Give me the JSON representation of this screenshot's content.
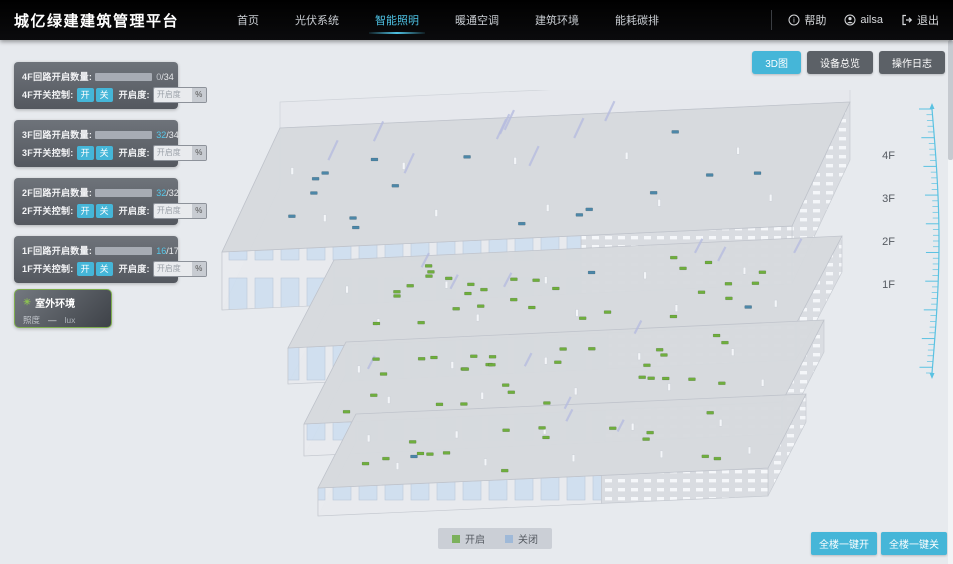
{
  "header": {
    "title": "城亿绿建建筑管理平台",
    "nav": [
      {
        "label": "首页",
        "active": false
      },
      {
        "label": "光伏系统",
        "active": false
      },
      {
        "label": "智能照明",
        "active": true
      },
      {
        "label": "暖通空调",
        "active": false
      },
      {
        "label": "建筑环境",
        "active": false
      },
      {
        "label": "能耗碳排",
        "active": false
      }
    ],
    "help": "帮助",
    "user": "ailsa",
    "logout": "退出"
  },
  "view_buttons": [
    {
      "label": "3D图",
      "active": true
    },
    {
      "label": "设备总览",
      "active": false
    },
    {
      "label": "操作日志",
      "active": false
    }
  ],
  "floor_panels": {
    "open_btn": "开",
    "close_btn": "关",
    "opacity_label": "开启度:",
    "opacity_placeholder": "开启度",
    "percent_label": "%",
    "floors": [
      {
        "circuit_label": "4F回路开启数量:",
        "switch_label": "4F开关控制:",
        "open": 0,
        "total": 34,
        "open_text": "0",
        "total_text": "/34"
      },
      {
        "circuit_label": "3F回路开启数量:",
        "switch_label": "3F开关控制:",
        "open": 32,
        "total": 34,
        "open_text": "32",
        "total_text": "/34"
      },
      {
        "circuit_label": "2F回路开启数量:",
        "switch_label": "2F开关控制:",
        "open": 32,
        "total": 32,
        "open_text": "32",
        "total_text": "/32"
      },
      {
        "circuit_label": "1F回路开启数量:",
        "switch_label": "1F开关控制:",
        "open": 16,
        "total": 17,
        "open_text": "16",
        "total_text": "/17"
      }
    ]
  },
  "outdoor": {
    "title": "室外环境",
    "metric": "照度",
    "value": "—",
    "unit": "lux"
  },
  "floor_axis_labels": [
    "4F",
    "3F",
    "2F",
    "1F"
  ],
  "legend": {
    "items": [
      {
        "label": "开启",
        "color": "#7cb15c"
      },
      {
        "label": "关闭",
        "color": "#9fb9d8"
      }
    ]
  },
  "footer_buttons": [
    {
      "label": "全楼一键开"
    },
    {
      "label": "全楼一键关"
    }
  ],
  "colors": {
    "accent": "#45b6d8",
    "marker_on": "#6fae3e",
    "marker_off": "#4c87a8"
  }
}
